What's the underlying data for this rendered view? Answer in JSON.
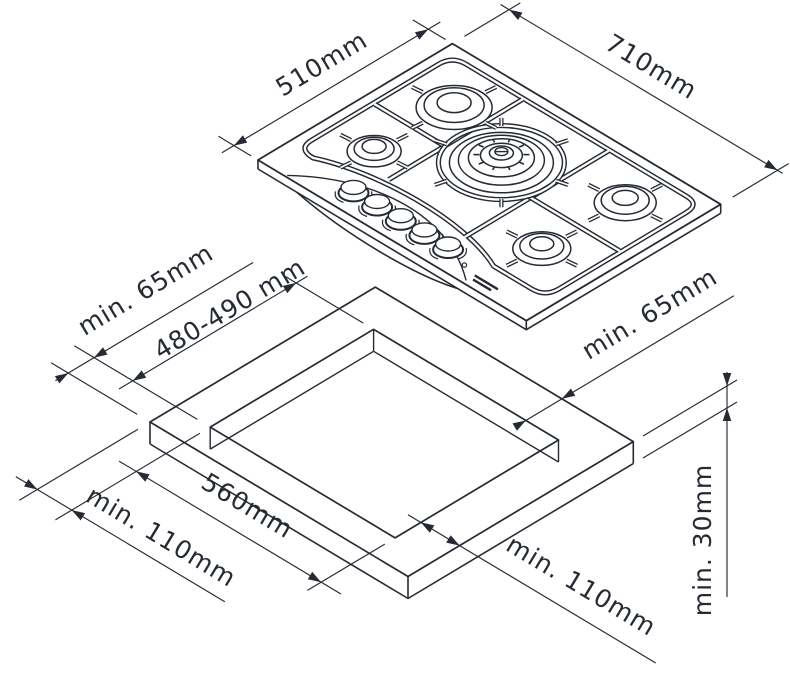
{
  "diagram": {
    "type": "gas-hob-installation-dimensions",
    "hob_view": {
      "depth_label": "510mm",
      "width_label": "710mm",
      "burner_count": 5,
      "knob_count": 5
    },
    "cutout_view": {
      "clearance_left_label": "min. 65mm",
      "cutout_depth_label": "480-490 mm",
      "clearance_right_label": "min. 65mm",
      "cutout_width_label": "560mm",
      "margin_left_label": "min. 110mm",
      "margin_right_label": "min. 110mm",
      "worktop_thickness_label": "min. 30mm"
    },
    "colors": {
      "ink": "#252a33",
      "background": "#ffffff"
    }
  }
}
